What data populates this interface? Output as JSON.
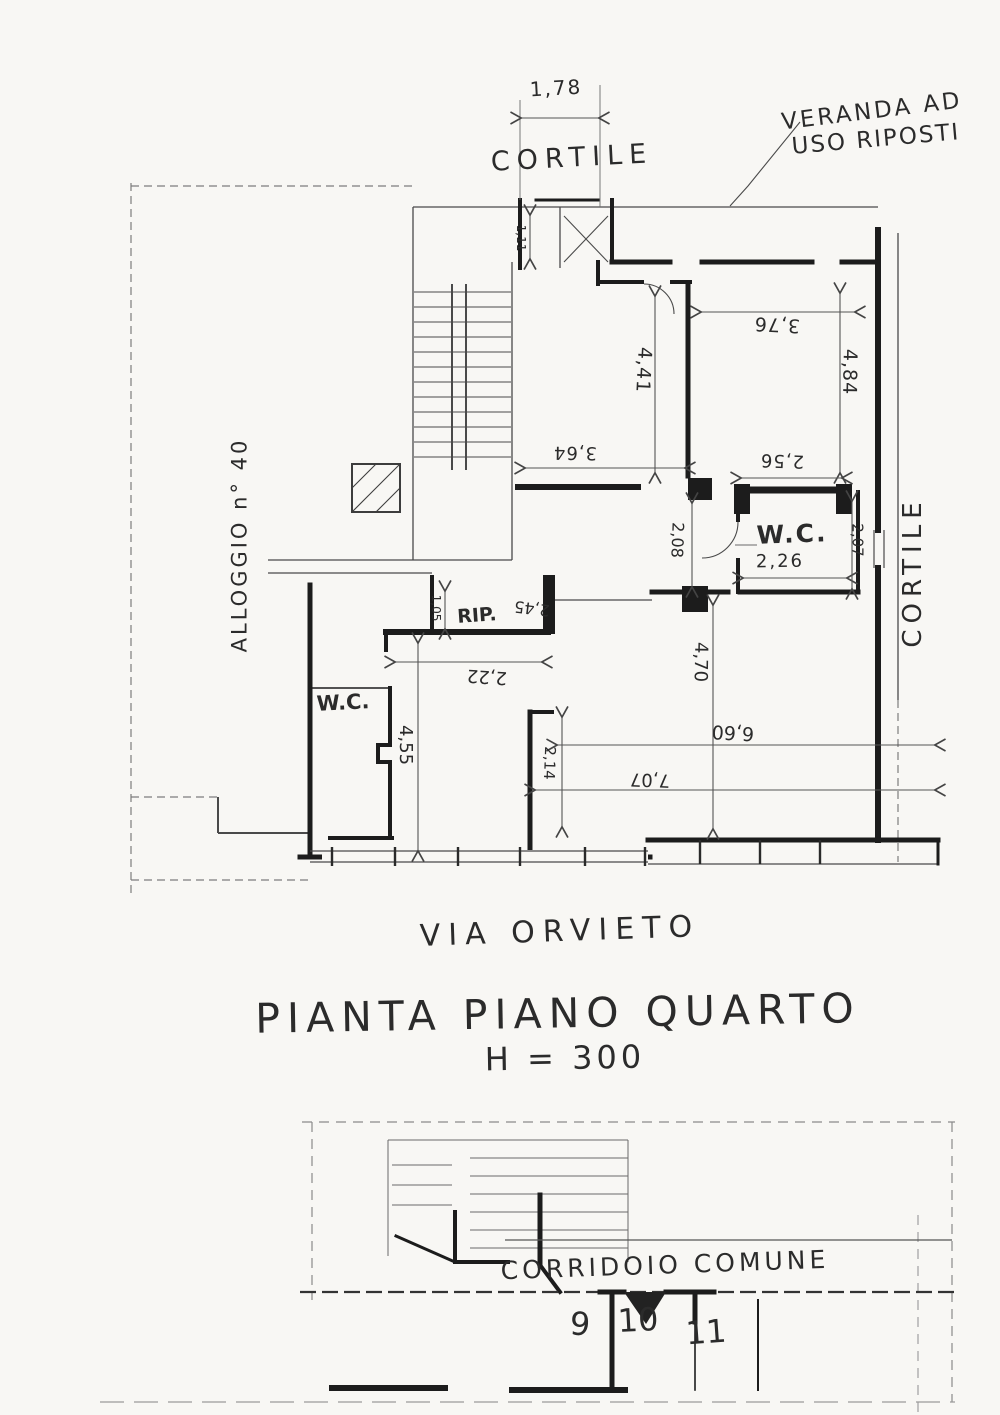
{
  "titles": {
    "plan_title": "PIANTA PIANO QUARTO",
    "plan_height": "H = 300",
    "street": "VIA ORVIETO"
  },
  "upper_plan": {
    "cortile_top": "CORTILE",
    "cortile_right": "CORTILE",
    "veranda_line1": "VERANDA AD",
    "veranda_line2": "USO RIPOSTI",
    "neighbor": "ALLOGGIO n° 40",
    "wc_right_label": "W.C.",
    "wc_left_label": "W.C.",
    "rip_label": "RIP.",
    "dims": {
      "d178": "1,78",
      "d376": "3,76",
      "d441": "4,41",
      "d484": "4,84",
      "d256": "2,56",
      "d364": "3,64",
      "d208": "2,08",
      "d226": "2,26",
      "d207": "2,07",
      "d245": "2,45",
      "d105": "1,05",
      "d111": "1,11",
      "d222": "2,22",
      "d455": "4,55",
      "d214": "2,14",
      "d470": "4,70",
      "d660": "6,60",
      "d707": "7,07"
    }
  },
  "lower_plan": {
    "corridor": "CORRIDOIO COMUNE",
    "units": [
      "9",
      "10",
      "11"
    ]
  }
}
